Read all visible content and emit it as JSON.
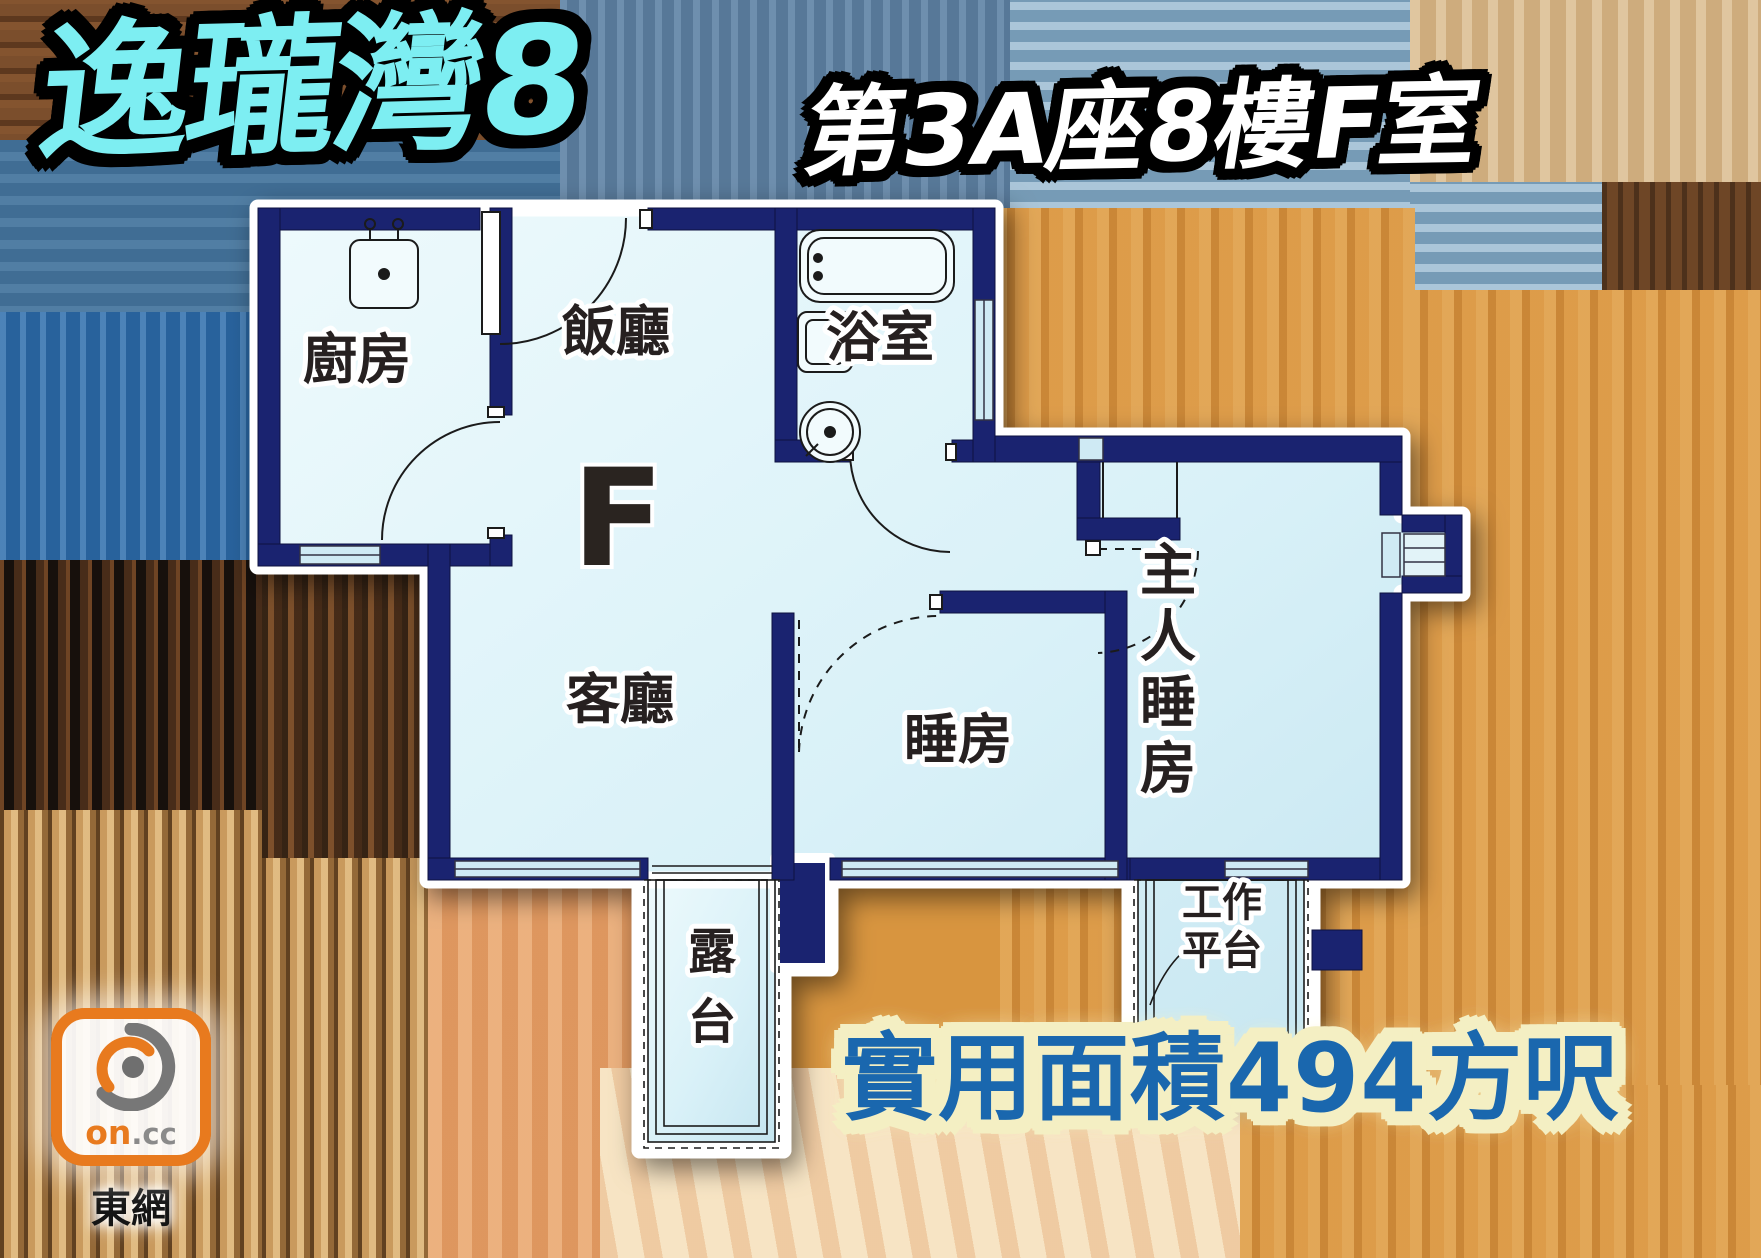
{
  "header": {
    "project_name": "逸瓏灣8",
    "unit_title": "第3A座8樓F室"
  },
  "floorplan": {
    "flat_letter": "F",
    "labels": {
      "kitchen": "廚房",
      "dining_room": "飯廳",
      "bathroom": "浴室",
      "living_room": "客廳",
      "bedroom": "睡房",
      "master_bedroom_chars": [
        "主",
        "人",
        "睡",
        "房"
      ],
      "balcony_chars": [
        "露",
        "台"
      ],
      "utility_platform_lines": [
        "工作",
        "平台"
      ]
    }
  },
  "footer": {
    "area_label": "實用面積494方呎"
  },
  "logo": {
    "brand_primary": "on",
    "brand_suffix": ".cc",
    "site_name": "東網"
  },
  "colors": {
    "title_fill": "#7deef2",
    "subtitle_fill": "#ffffff",
    "area_text_fill": "#1a67ae",
    "area_halo": "#f4efc3",
    "wall": "#1a2370",
    "room_fill": "#d9f1f8",
    "plan_outline": "#ffffff",
    "window_fill": "#cfeaf4",
    "logo_orange": "#e87a1e"
  }
}
